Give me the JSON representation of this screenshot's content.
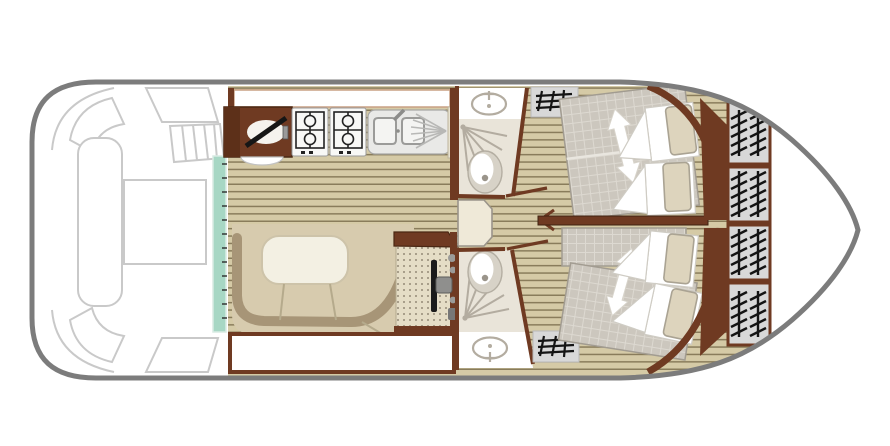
{
  "figure": {
    "kind": "boat-deck-floor-plan",
    "rooms": [
      {
        "name": "bow-deck",
        "label": "open deck with bench, table and steps"
      },
      {
        "name": "galley",
        "label": "kitchen with fridge top, 4-burner stove and sink"
      },
      {
        "name": "salon",
        "label": "U-shaped bench seating with table"
      },
      {
        "name": "helm",
        "label": "steering console with wheel"
      },
      {
        "name": "bathroom-top",
        "label": "washbasin, shower and toilet"
      },
      {
        "name": "bathroom-bottom",
        "label": "washbasin, shower and toilet"
      },
      {
        "name": "cabin-top",
        "label": "double bed with pillows, convertible (arrow)"
      },
      {
        "name": "cabin-bottom",
        "label": "double bed with pillows, convertible (arrow)"
      },
      {
        "name": "stern-lockers",
        "label": "four hatched engine/storage vents"
      }
    ],
    "icons": [
      "stove-icon",
      "sink-icon",
      "drainer-icon",
      "fridge-top-icon",
      "washbasin-icon",
      "toilet-icon",
      "shower-spray-icon",
      "steering-wheel-icon",
      "bed-direction-arrow-icon",
      "steps-hatch-icon",
      "vent-hatch-icon",
      "sliding-door-glass"
    ]
  },
  "colors": {
    "hull": "#7c7c7c",
    "deck_line": "#c9c9c9",
    "wood_base": "#d5caa6",
    "wood_line": "#7c6f4e",
    "brown": "#6f3a22",
    "brown_dark": "#48260f",
    "teal": "#a7d7c4",
    "bench_tan": "#d7cbae",
    "bench_band": "#a79577",
    "table_cream": "#f3f0e3",
    "table_edge": "#cdc3a9",
    "mattress": "#ccc7be",
    "mattress_grid": "#ddd9d1",
    "mattress_edge": "#a29c91",
    "pillow": "#ddd4bd",
    "pillow_edge": "#aaa393",
    "bath_floor": "#e9e4d9",
    "fixture_gray": "#b3aca0",
    "toilet_fill": "#d7d2c7",
    "steps_gray": "#d8d8d8",
    "hatch_black": "#141414",
    "console_beige": "#e5ddc6",
    "white": "#ffffff",
    "window_edge": "#c9a084"
  }
}
